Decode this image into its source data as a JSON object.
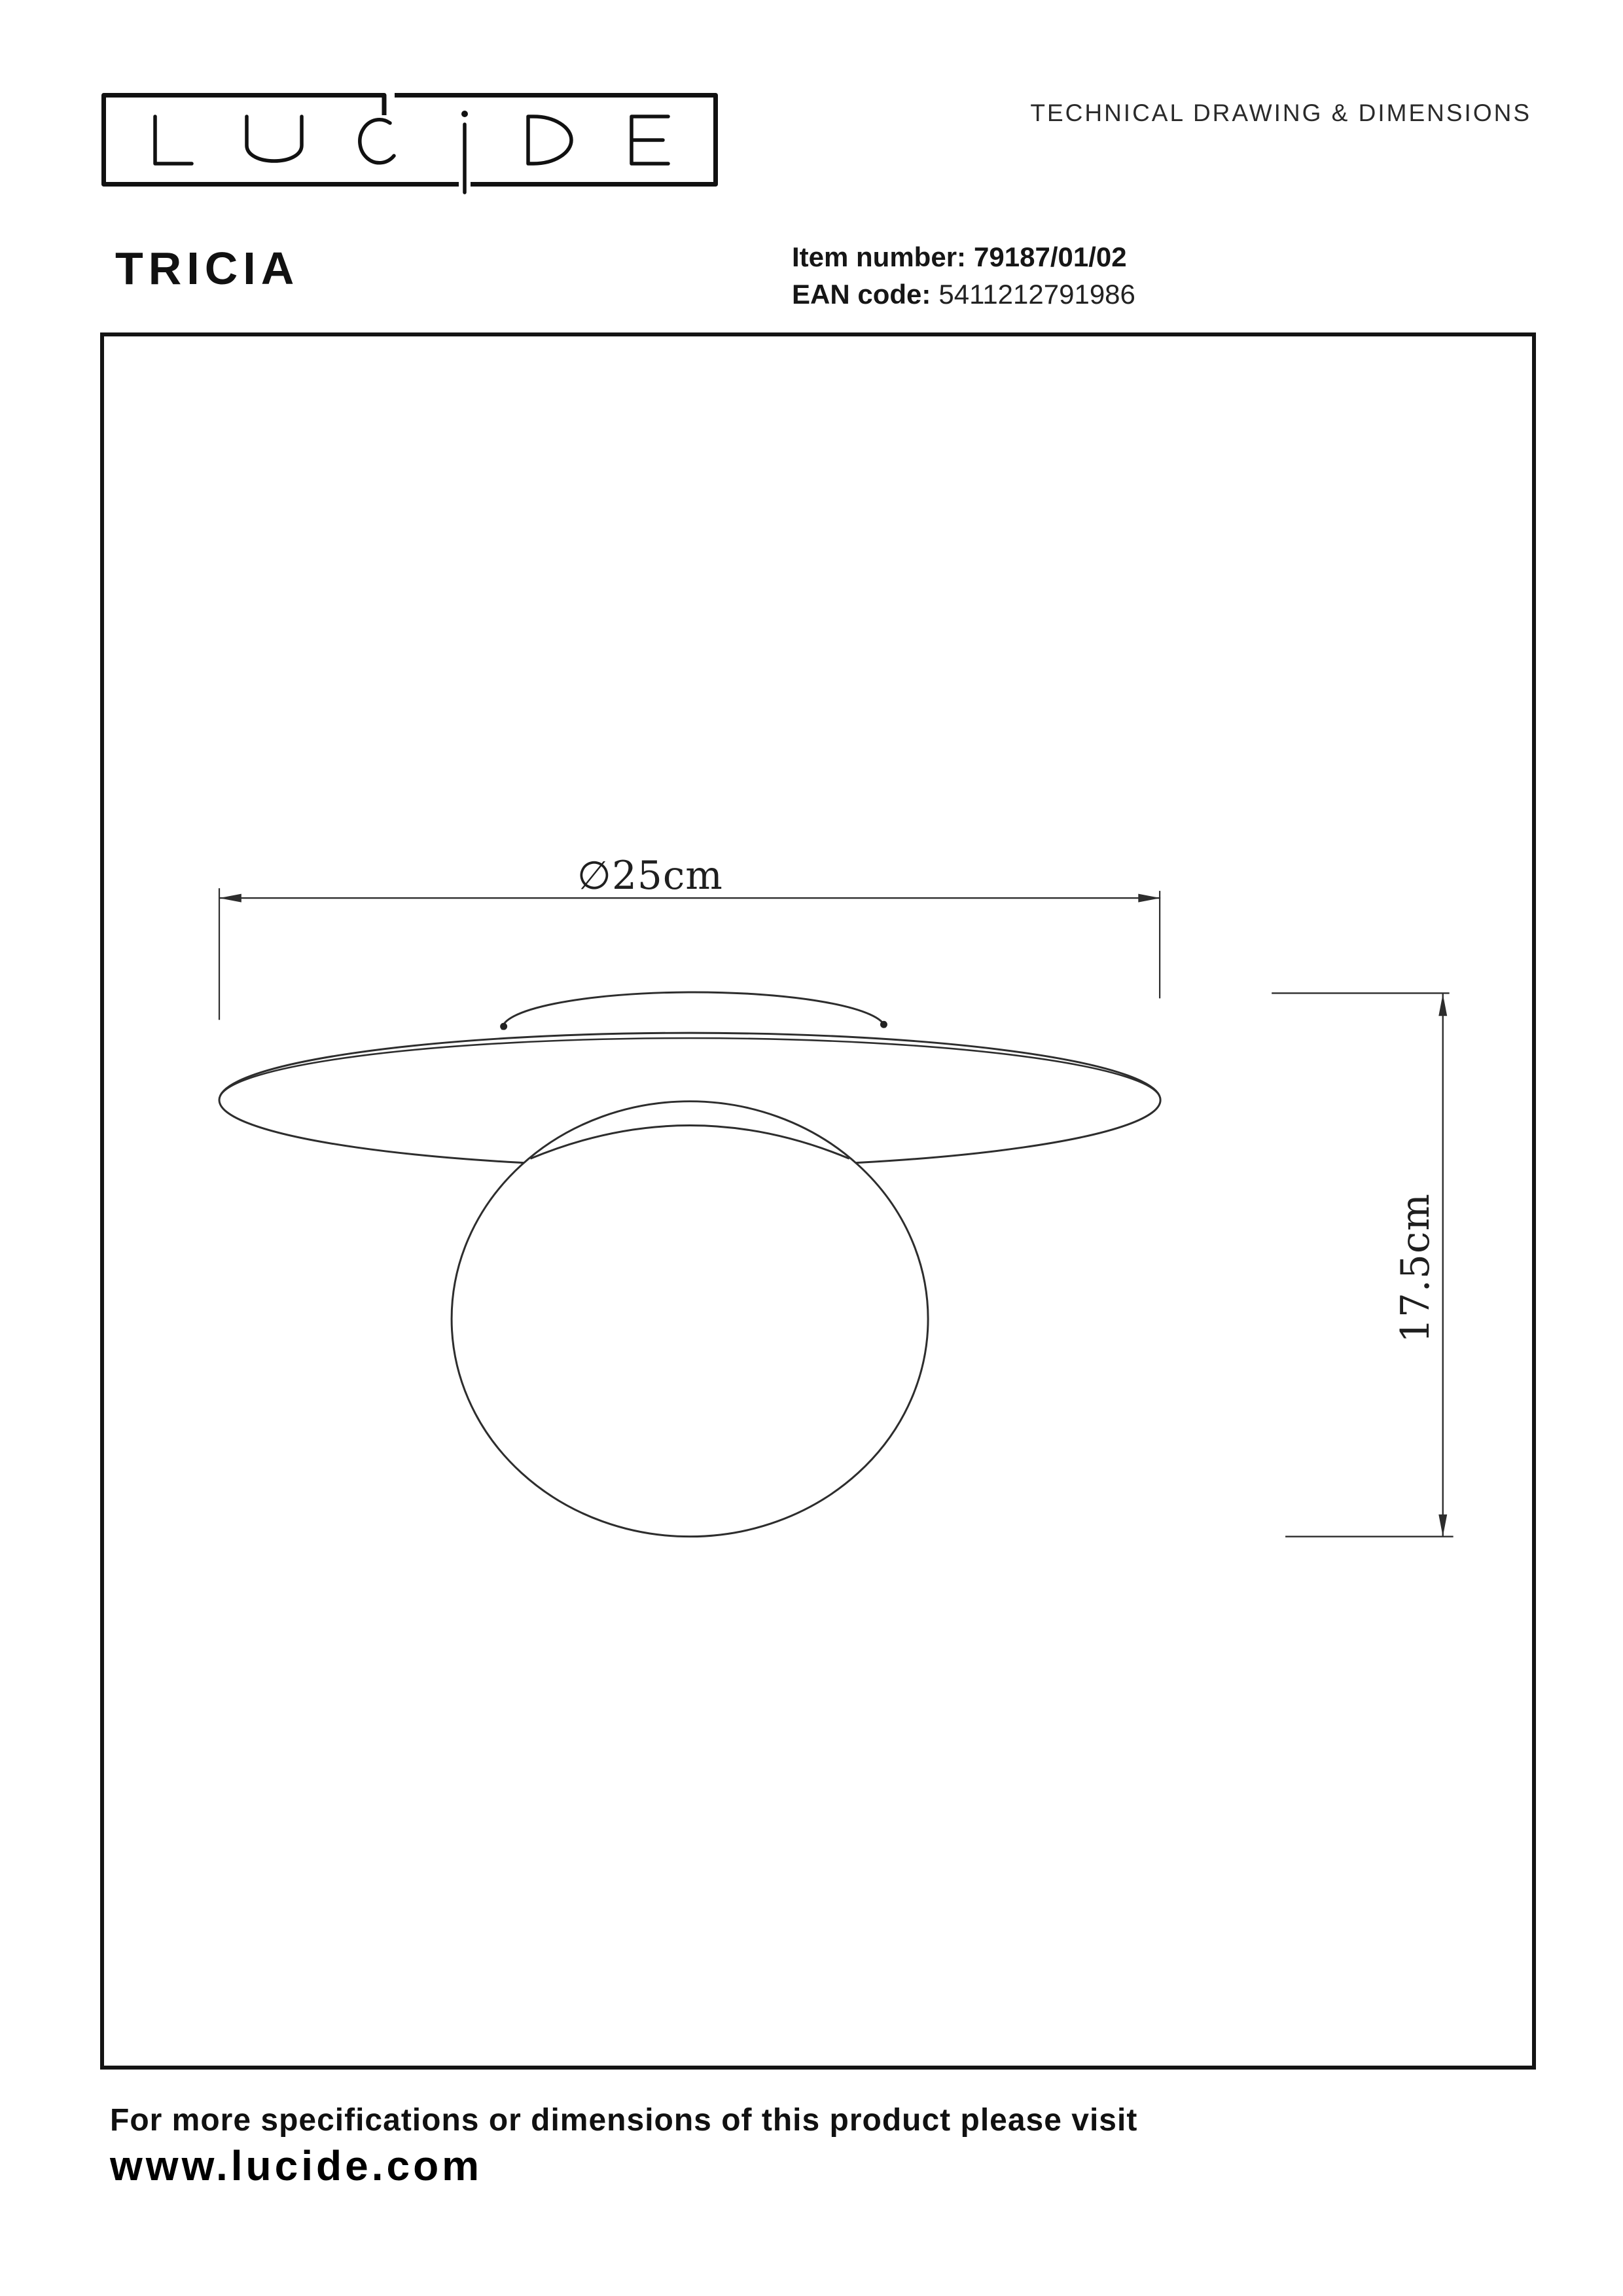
{
  "header": {
    "brand": "LUCIDE",
    "doc_type": "TECHNICAL DRAWING & DIMENSIONS"
  },
  "product": {
    "name": "TRICIA",
    "item_number_label": "Item number:",
    "item_number": "79187/01/02",
    "ean_label": "EAN code:",
    "ean": "5411212791986"
  },
  "drawing": {
    "diameter_label": "∅25cm",
    "height_label": "17.5cm"
  },
  "footer": {
    "note": "For more specifications or dimensions of this product please visit",
    "website": "www.lucide.com"
  },
  "colors": {
    "ink": "#161616",
    "line": "#2d2d2d"
  }
}
